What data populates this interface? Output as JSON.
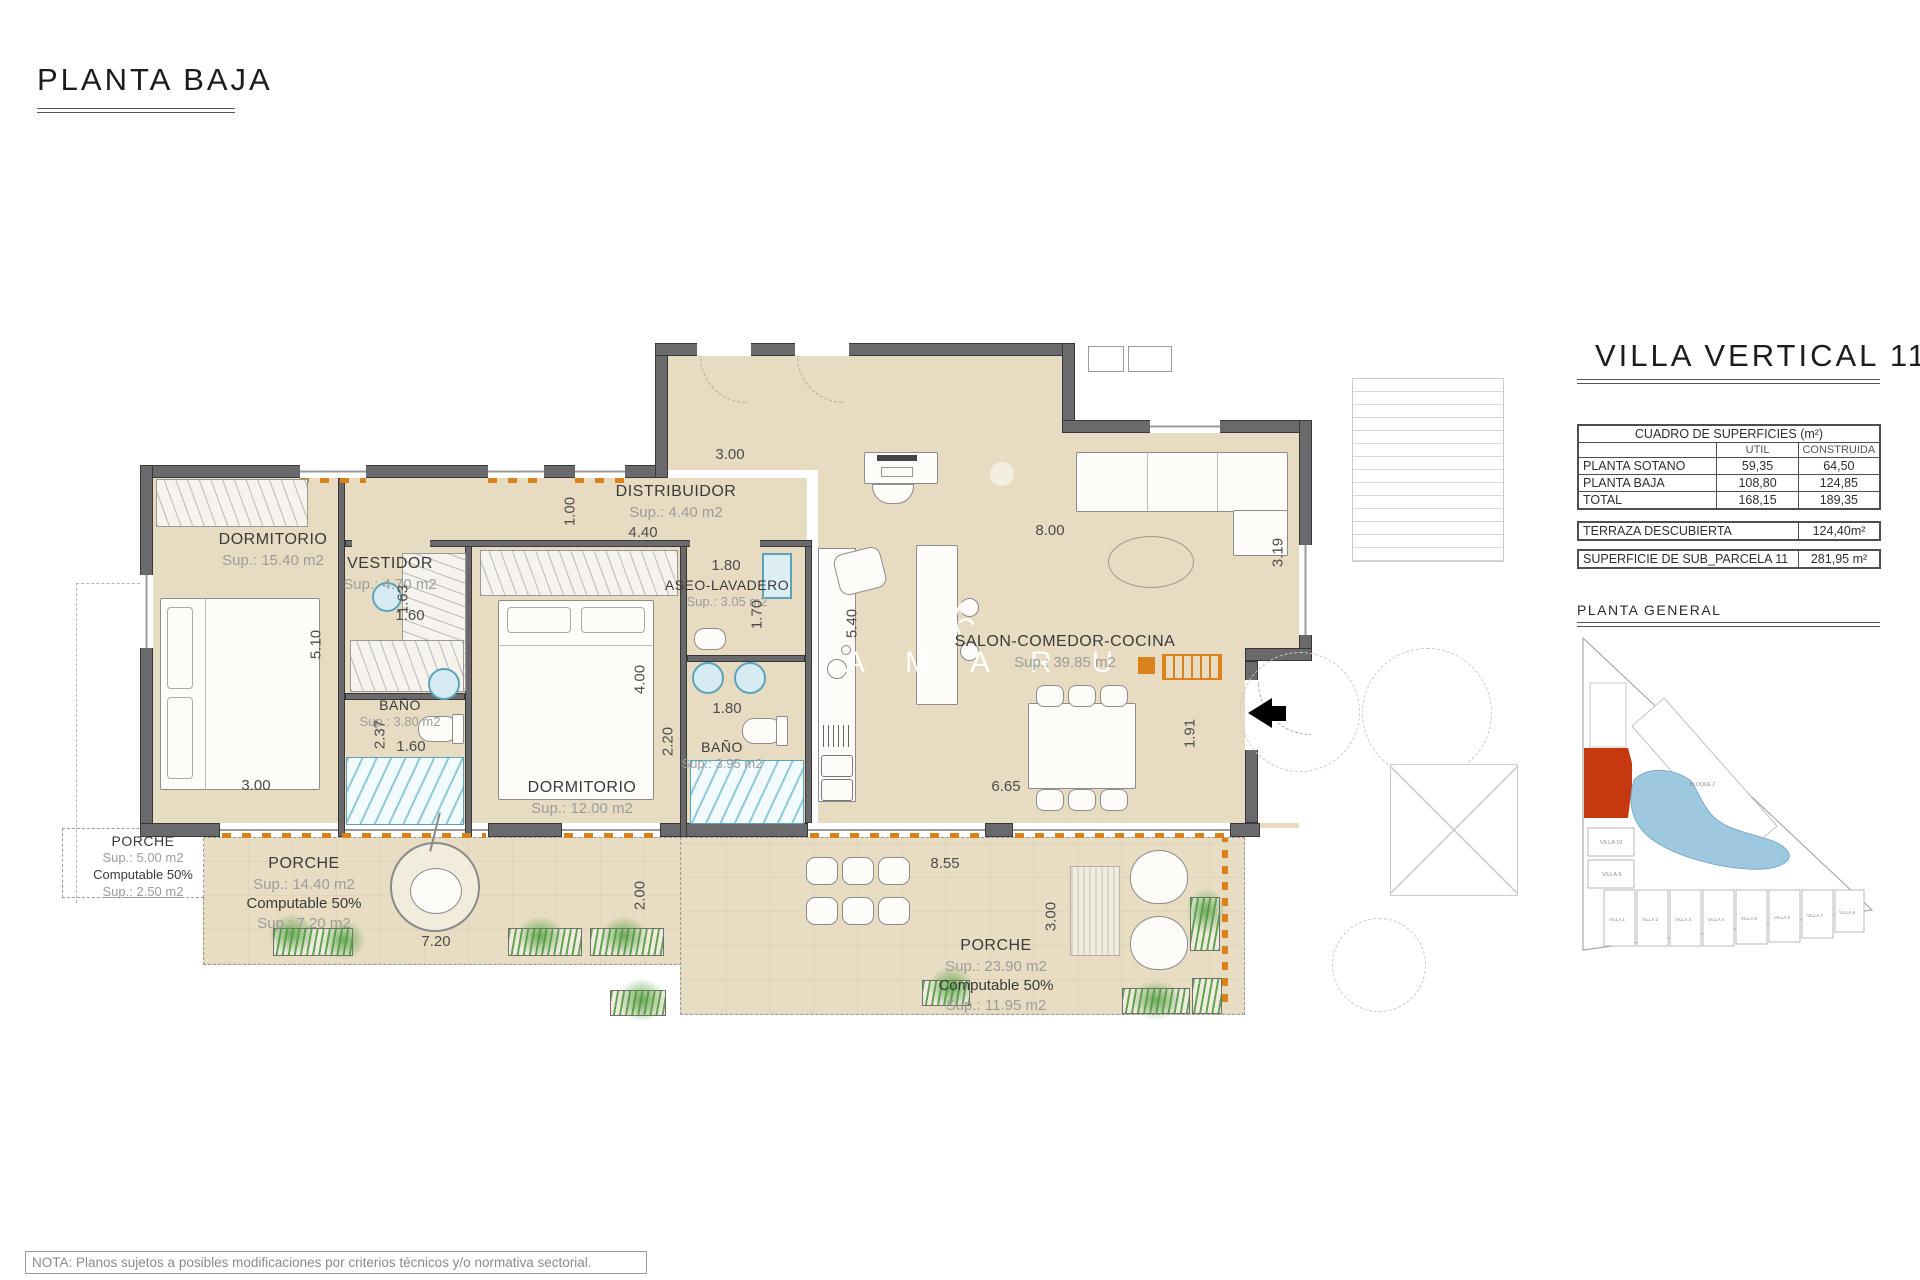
{
  "page": {
    "title": "PLANTA BAJA",
    "note": "NOTA: Planos sujetos a posibles modificaciones por criterios técnicos y/o normativa sectorial."
  },
  "panel": {
    "title": "VILLA VERTICAL 11",
    "table": {
      "title": "CUADRO DE SUPERFICIES (m²)",
      "col_util": "UTIL",
      "col_construida": "CONSTRUIDA",
      "rows": [
        {
          "label": "PLANTA SOTANO",
          "util": "59,35",
          "construida": "64,50"
        },
        {
          "label": "PLANTA BAJA",
          "util": "108,80",
          "construida": "124,85"
        },
        {
          "label": "TOTAL",
          "util": "168,15",
          "construida": "189,35"
        }
      ]
    },
    "terraza": {
      "label": "TERRAZA DESCUBIERTA",
      "value": "124,40m²"
    },
    "parcela": {
      "label": "SUPERFICIE DE SUB_PARCELA  11",
      "value": "281,95 m²"
    },
    "site": {
      "title": "PLANTA GENERAL",
      "bloque": "BLOQUE 2",
      "left_villas": [
        "VILLA 10",
        "VILLA 9"
      ],
      "bottom_villas": [
        "VILLA 1",
        "VILLA 2",
        "VILLA 3",
        "VILLA 4",
        "VILLA 5",
        "VILLA 6",
        "VILLA 7",
        "VILLA 8"
      ]
    }
  },
  "watermark": "AMARU",
  "rooms": {
    "dorm1": {
      "name": "DORMITORIO",
      "sup": "Sup.: 15.40  m2"
    },
    "vestidor": {
      "name": "VESTIDOR",
      "sup": "Sup.: 4.70  m2"
    },
    "distribuidor": {
      "name": "DISTRIBUIDOR",
      "sup": "Sup.: 4.40  m2"
    },
    "aseo": {
      "name": "ASEO-LAVADERO",
      "sup": "Sup.: 3.05  m2"
    },
    "salon": {
      "name": "SALON-COMEDOR-COCINA",
      "sup": "Sup.: 39.85  m2"
    },
    "banio1": {
      "name": "BAÑO",
      "sup": "Sup.: 3.80  m2"
    },
    "dorm2": {
      "name": "DORMITORIO",
      "sup": "Sup.: 12.00  m2"
    },
    "banio2": {
      "name": "BAÑO",
      "sup": "Sup.: 3.95  m2"
    },
    "porche1": {
      "name": "PORCHE",
      "sup": "Sup.: 5.00  m2",
      "computable": "Computable 50%",
      "sup2": "Sup.: 2.50  m2"
    },
    "porche2": {
      "name": "PORCHE",
      "sup": "Sup.: 14.40 m2",
      "computable": "Computable 50%",
      "sup2": "Sup.: 7.20  m2"
    },
    "porche3": {
      "name": "PORCHE",
      "sup": "Sup.: 23.90  m2",
      "computable": "Computable 50%",
      "sup2": "Sup.: 11.95  m2"
    }
  },
  "dims": [
    "5.10",
    "3.00",
    "1.63",
    "1.60",
    "1.00",
    "4.40",
    "3.00",
    "1.80",
    "1.70",
    "5.40",
    "8.00",
    "3.19",
    "2.37",
    "1.60",
    "4.00",
    "2.20",
    "1.80",
    "1.91",
    "6.65",
    "8.55",
    "3.00",
    "2.00",
    "7.20"
  ]
}
